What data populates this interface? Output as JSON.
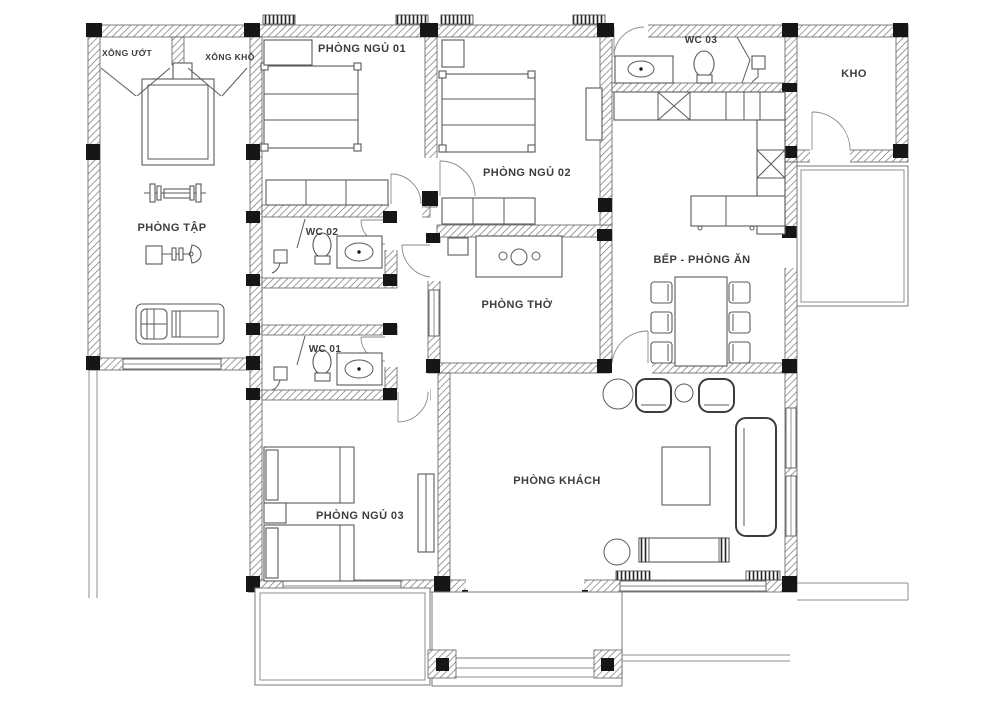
{
  "drawing": {
    "type": "house-floor-plan",
    "rooms": {
      "sauna_wet": {
        "label": "XÔNG ƯỚT"
      },
      "sauna_dry": {
        "label": "XÔNG KHÔ"
      },
      "bedroom1": {
        "label": "PHÒNG NGỦ 01"
      },
      "bedroom2": {
        "label": "PHÒNG NGỦ 02"
      },
      "bedroom3": {
        "label": "PHÒNG NGỦ 03"
      },
      "wc1": {
        "label": "WC 01"
      },
      "wc2": {
        "label": "WC 02"
      },
      "wc3": {
        "label": "WC 03"
      },
      "storage": {
        "label": "KHO"
      },
      "gym": {
        "label": "PHÒNG TẬP"
      },
      "worship": {
        "label": "PHÒNG THỜ"
      },
      "kitchen_dining": {
        "label": "BẾP - PHÒNG ĂN"
      },
      "living": {
        "label": "PHÒNG KHÁCH"
      }
    },
    "colors": {
      "background": "#ffffff",
      "wall_hatch": "#7a7a7a",
      "line": "#5a5a5a",
      "column": "#161616",
      "label": "#3d3d3d"
    }
  }
}
